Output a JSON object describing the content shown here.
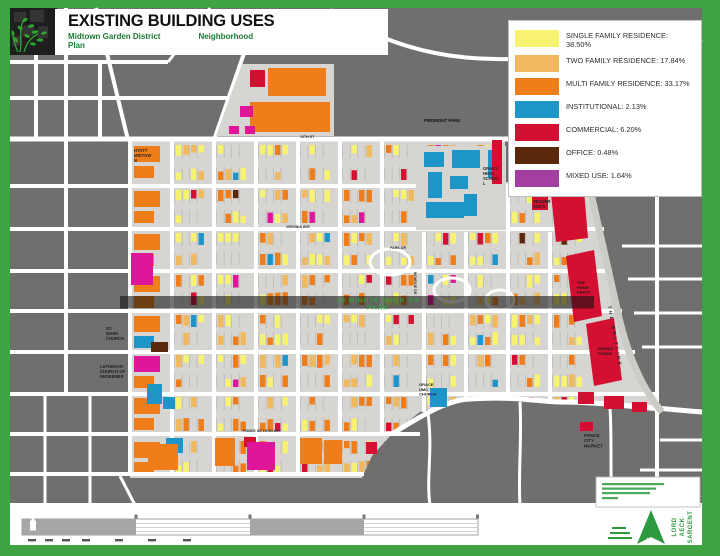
{
  "header": {
    "title": "EXISTING BUILDING USES",
    "subtitle_line1_left": "Midtown Garden District",
    "subtitle_line1_right": "Neighborhood",
    "subtitle_line2": "Plan"
  },
  "legend": {
    "items": [
      {
        "name": "SINGLE FAMILY RESIDENCE",
        "percent": "38.50%",
        "color": "#F7F370"
      },
      {
        "name": "TWO FAMILY RESIDENCE",
        "percent": "17.84%",
        "color": "#F0B95E"
      },
      {
        "name": "MULTI FAMILY RESIDENCE",
        "percent": "33.17%",
        "color": "#EF7D1A"
      },
      {
        "name": "INSTITUTIONAL",
        "percent": "2.13%",
        "color": "#1E95C8"
      },
      {
        "name": "COMMERCIAL",
        "percent": "6.20%",
        "color": "#D31032"
      },
      {
        "name": "OFFICE",
        "percent": "0.48%",
        "color": "#5B280C"
      },
      {
        "name": "MIXED USE",
        "percent": "1.64%",
        "color": "#A23FA0"
      }
    ]
  },
  "map": {
    "background_color": "#6F6F6E",
    "block_color": "#D6D5D2",
    "street_color": "#FFFFFF",
    "border_color": "#3FA344",
    "lot_line_color": "#ABAAA7",
    "beltline_color": "#CCCBC8",
    "building_colors": {
      "single": "#F7F370",
      "two": "#F0B95E",
      "multi": "#EF7D1A",
      "institutional": "#1E95C8",
      "commercial": "#D31032",
      "office": "#5B280C",
      "mixed": "#E0169A"
    },
    "banner": {
      "lines": [
        "10 MINUTE WALK TO",
        "PARK"
      ],
      "color": "#2FA040"
    },
    "labels": [
      {
        "id": "hyatt-midtown",
        "lines": [
          "HYATT",
          "MIDTOW",
          "N"
        ],
        "x": 134,
        "y": 152,
        "size": 4.2,
        "color": "#222222"
      },
      {
        "id": "piedmont-park",
        "lines": [
          "PIEDMONT PARK"
        ],
        "x": 424,
        "y": 122,
        "size": 4.4,
        "color": "#111111"
      },
      {
        "id": "grady-high-school",
        "lines": [
          "GRADY",
          "HIGH",
          "SCHOO",
          "L"
        ],
        "x": 483,
        "y": 170,
        "size": 4.2,
        "color": "#222222"
      },
      {
        "id": "trader-joes",
        "lines": [
          "TRADER",
          "JOE'S"
        ],
        "x": 533,
        "y": 203,
        "size": 4.2,
        "color": "#222222"
      },
      {
        "id": "home-depot",
        "lines": [
          "THE",
          "HOME",
          "DEPOT"
        ],
        "x": 577,
        "y": 284,
        "size": 4.0,
        "color": "#1a1a1a"
      },
      {
        "id": "whole-foods",
        "lines": [
          "WHOLE",
          "FOODS"
        ],
        "x": 598,
        "y": 350,
        "size": 4.0,
        "color": "#1a1a1a"
      },
      {
        "id": "the-beltline",
        "lines": [
          "THE BELTLINE"
        ],
        "x": 608,
        "y": 306,
        "size": 4.6,
        "color": "#2b2b2b",
        "rotate": 80,
        "spacing": 2.5
      },
      {
        "id": "st-mark-church",
        "lines": [
          "ST.",
          "MARK",
          "CHURCH"
        ],
        "x": 106,
        "y": 330,
        "size": 4.2,
        "color": "#1d1d1d"
      },
      {
        "id": "lutheran-church",
        "lines": [
          "LUTHERAN",
          "CHURCH OF",
          "REDEEMER"
        ],
        "x": 100,
        "y": 368,
        "size": 4.2,
        "color": "#1d1d1d"
      },
      {
        "id": "grace-umc-church",
        "lines": [
          "GRACE",
          "UMC",
          "CHURCH"
        ],
        "x": 419,
        "y": 386,
        "size": 4.0,
        "color": "#1d1d1d"
      },
      {
        "id": "ponce-city-market",
        "lines": [
          "PONCE",
          "CITY",
          "MARKET"
        ],
        "x": 584,
        "y": 437,
        "size": 4.4,
        "color": "#1d1d1d"
      },
      {
        "id": "street-10th-st",
        "lines": [
          "10TH ST"
        ],
        "x": 300,
        "y": 138,
        "size": 3.6,
        "color": "#333333"
      },
      {
        "id": "street-virginia-ave",
        "lines": [
          "VIRGINIA AVE"
        ],
        "x": 286,
        "y": 228,
        "size": 3.6,
        "color": "#333333"
      },
      {
        "id": "street-park-dr",
        "lines": [
          "PARK DR"
        ],
        "x": 390,
        "y": 249,
        "size": 3.6,
        "color": "#333333"
      },
      {
        "id": "street-monroe-dr",
        "lines": [
          "MONROE DR"
        ],
        "x": 414,
        "y": 272,
        "size": 3.6,
        "color": "#333333",
        "rotate": 90
      },
      {
        "id": "street-ponce-de-leon",
        "lines": [
          "PONCE DE LEON AVE"
        ],
        "x": 243,
        "y": 432,
        "size": 3.6,
        "color": "#333333"
      }
    ]
  },
  "footer": {
    "north_label": "N",
    "firm_words": [
      "LORD",
      "AECK",
      "SARGENT"
    ]
  }
}
